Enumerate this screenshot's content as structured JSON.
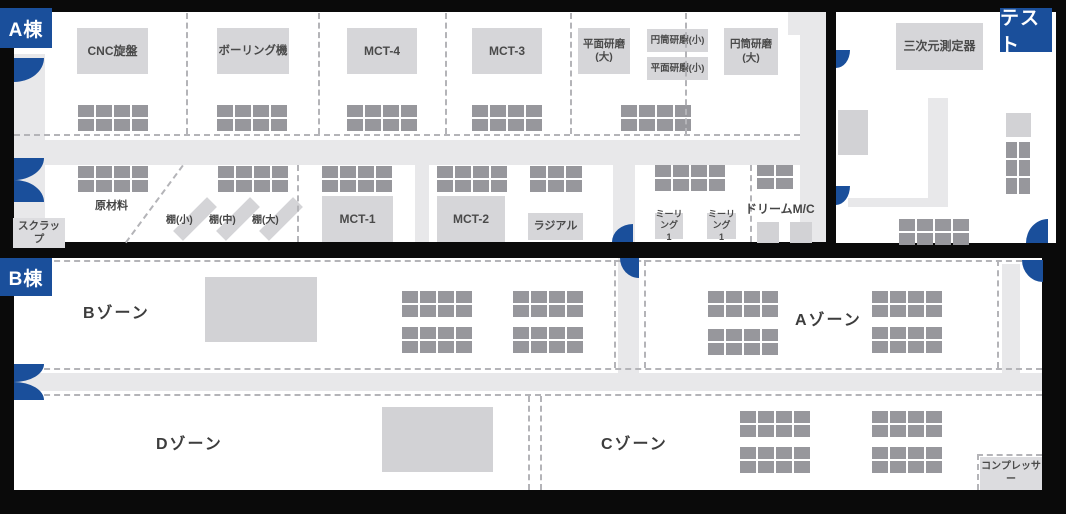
{
  "tags": {
    "building_a": "A棟",
    "building_b": "B棟",
    "test_room": "テスト"
  },
  "colors": {
    "background": "#0a0a0a",
    "interior": "#ffffff",
    "walkway": "#e8e8ea",
    "equipment_box": "#d6d6d9",
    "pallet": "#97979c",
    "accent_blue": "#1a4f9b",
    "dashed_line": "#b4b4b8",
    "label_text": "#454545"
  },
  "machines": [
    {
      "name": "machine-cnc-lathe",
      "label": "CNC旋盤",
      "x": 77,
      "y": 28,
      "w": 71,
      "h": 46,
      "fs": 12
    },
    {
      "name": "machine-boring",
      "label": "ボーリング機",
      "x": 217,
      "y": 28,
      "w": 72,
      "h": 46,
      "fs": 11.5
    },
    {
      "name": "machine-mct-4",
      "label": "MCT-4",
      "x": 347,
      "y": 28,
      "w": 70,
      "h": 46,
      "fs": 12
    },
    {
      "name": "machine-mct-3",
      "label": "MCT-3",
      "x": 472,
      "y": 28,
      "w": 70,
      "h": 46,
      "fs": 12
    },
    {
      "name": "machine-surface-grinder-large",
      "label": "平面研磨\n(大)",
      "x": 578,
      "y": 28,
      "w": 52,
      "h": 46,
      "fs": 10.5
    },
    {
      "name": "machine-cylindrical-grinder-small",
      "label": "円筒研磨(小)",
      "x": 647,
      "y": 29,
      "w": 61,
      "h": 23,
      "fs": 9.5
    },
    {
      "name": "machine-surface-grinder-small",
      "label": "平面研磨(小)",
      "x": 647,
      "y": 57,
      "w": 61,
      "h": 23,
      "fs": 9.5
    },
    {
      "name": "machine-cylindrical-grinder-large",
      "label": "円筒研磨\n(大)",
      "x": 724,
      "y": 28,
      "w": 54,
      "h": 47,
      "fs": 10.5
    },
    {
      "name": "machine-mct-1",
      "label": "MCT-1",
      "x": 322,
      "y": 196,
      "w": 71,
      "h": 46,
      "fs": 12
    },
    {
      "name": "machine-mct-2",
      "label": "MCT-2",
      "x": 437,
      "y": 196,
      "w": 68,
      "h": 46,
      "fs": 12
    },
    {
      "name": "machine-radial",
      "label": "ラジアル",
      "x": 528,
      "y": 213,
      "w": 55,
      "h": 27,
      "fs": 11
    },
    {
      "name": "machine-milling-1a",
      "label": "ミーリング\n1",
      "x": 655,
      "y": 213,
      "w": 28,
      "h": 26,
      "fs": 9
    },
    {
      "name": "machine-milling-1b",
      "label": "ミーリング\n1",
      "x": 707,
      "y": 213,
      "w": 29,
      "h": 26,
      "fs": 9
    },
    {
      "name": "machine-cmm",
      "label": "三次元測定器",
      "x": 896,
      "y": 23,
      "w": 87,
      "h": 47,
      "fs": 12
    },
    {
      "name": "area-scrap",
      "label": "スクラップ",
      "x": 13,
      "y": 218,
      "w": 52,
      "h": 30,
      "fs": 10.5,
      "light": true
    },
    {
      "name": "area-compressor",
      "label": "コンプレッサー",
      "x": 980,
      "y": 457,
      "w": 62,
      "h": 33,
      "fs": 10,
      "light": true
    }
  ],
  "plain_boxes": [
    {
      "name": "bzone-equipment-block",
      "x": 205,
      "y": 277,
      "w": 112,
      "h": 65
    },
    {
      "name": "dzone-equipment-block",
      "x": 382,
      "y": 407,
      "w": 111,
      "h": 65
    },
    {
      "name": "test-west-equipment-block",
      "x": 838,
      "y": 110,
      "w": 30,
      "h": 45
    },
    {
      "name": "test-east-equipment-block",
      "x": 1006,
      "y": 113,
      "w": 25,
      "h": 24
    },
    {
      "name": "dream-mc-unit-1",
      "x": 757,
      "y": 222,
      "w": 22,
      "h": 21
    },
    {
      "name": "dream-mc-unit-2",
      "x": 790,
      "y": 222,
      "w": 22,
      "h": 21
    }
  ],
  "labels": [
    {
      "name": "label-raw-materials",
      "text": "原材料",
      "x": 95,
      "y": 197,
      "fs": 11
    },
    {
      "name": "label-shelf-small",
      "text": "棚(小)",
      "x": 166,
      "y": 211,
      "fs": 10
    },
    {
      "name": "label-shelf-medium",
      "text": "棚(中)",
      "x": 209,
      "y": 211,
      "fs": 10
    },
    {
      "name": "label-shelf-large",
      "text": "棚(大)",
      "x": 252,
      "y": 211,
      "fs": 10
    },
    {
      "name": "label-dream-mc",
      "text": "ドリームM/C",
      "x": 745,
      "y": 200,
      "fs": 12
    }
  ],
  "zone_labels": [
    {
      "name": "label-zone-b",
      "text": "Bゾーン",
      "x": 83,
      "y": 299
    },
    {
      "name": "label-zone-a",
      "text": "Aゾーン",
      "x": 795,
      "y": 306
    },
    {
      "name": "label-zone-d",
      "text": "Dゾーン",
      "x": 156,
      "y": 430
    },
    {
      "name": "label-zone-c",
      "text": "Cゾーン",
      "x": 601,
      "y": 430
    }
  ],
  "shelves": [
    {
      "name": "shelf-small",
      "x": 188,
      "y": 195,
      "w": 14,
      "h": 48,
      "rot": 45
    },
    {
      "name": "shelf-medium",
      "x": 231,
      "y": 195,
      "w": 14,
      "h": 48,
      "rot": 45
    },
    {
      "name": "shelf-large",
      "x": 274,
      "y": 195,
      "w": 14,
      "h": 48,
      "rot": 45
    }
  ],
  "walkways": [
    {
      "name": "walkway-a-west",
      "x": 14,
      "y": 54,
      "w": 31,
      "h": 164
    },
    {
      "name": "walkway-a-main",
      "x": 14,
      "y": 140,
      "w": 812,
      "h": 25
    },
    {
      "name": "walkway-a-northeast",
      "x": 788,
      "y": 12,
      "w": 38,
      "h": 23
    },
    {
      "name": "walkway-a-east",
      "x": 800,
      "y": 12,
      "w": 26,
      "h": 230
    },
    {
      "name": "walkway-a-mid-1",
      "x": 415,
      "y": 165,
      "w": 14,
      "h": 77
    },
    {
      "name": "walkway-a-mid-2",
      "x": 613,
      "y": 165,
      "w": 22,
      "h": 77
    },
    {
      "name": "walkway-test-vertical",
      "x": 928,
      "y": 98,
      "w": 20,
      "h": 109
    },
    {
      "name": "walkway-test-horizontal",
      "x": 848,
      "y": 198,
      "w": 80,
      "h": 9
    },
    {
      "name": "walkway-b-main",
      "x": 14,
      "y": 373,
      "w": 1028,
      "h": 18
    },
    {
      "name": "walkway-b-mid",
      "x": 618,
      "y": 258,
      "w": 21,
      "h": 116
    },
    {
      "name": "walkway-b-east",
      "x": 1002,
      "y": 264,
      "w": 18,
      "h": 110
    }
  ],
  "dashed_lines": [
    {
      "name": "divider-a-1",
      "t": "v",
      "x": 186,
      "y": 13,
      "len": 121
    },
    {
      "name": "divider-a-2",
      "t": "v",
      "x": 318,
      "y": 13,
      "len": 121
    },
    {
      "name": "divider-a-3",
      "t": "v",
      "x": 445,
      "y": 13,
      "len": 121
    },
    {
      "name": "divider-a-4",
      "t": "v",
      "x": 570,
      "y": 13,
      "len": 121
    },
    {
      "name": "divider-a-5",
      "t": "v",
      "x": 685,
      "y": 13,
      "len": 121
    },
    {
      "name": "divider-a-top-row",
      "t": "h",
      "x": 14,
      "y": 134,
      "len": 786
    },
    {
      "name": "divider-shelf-east",
      "t": "v",
      "x": 297,
      "y": 165,
      "len": 77
    },
    {
      "name": "divider-dream-mc",
      "t": "v",
      "x": 750,
      "y": 165,
      "len": 77
    },
    {
      "name": "divider-scrap-diagonal",
      "t": "d",
      "x": 125,
      "y": 242,
      "len": 96,
      "rot": -53.5
    },
    {
      "name": "divider-b-north",
      "t": "h",
      "x": 14,
      "y": 260,
      "len": 1028
    },
    {
      "name": "divider-bzone-east",
      "t": "v",
      "x": 614,
      "y": 260,
      "len": 108
    },
    {
      "name": "divider-azone-west",
      "t": "v",
      "x": 644,
      "y": 260,
      "len": 108
    },
    {
      "name": "divider-azone-east",
      "t": "v",
      "x": 997,
      "y": 260,
      "len": 108
    },
    {
      "name": "divider-b-walkway-north",
      "t": "h",
      "x": 14,
      "y": 368,
      "len": 1028
    },
    {
      "name": "divider-b-walkway-south",
      "t": "h",
      "x": 14,
      "y": 394,
      "len": 1028
    },
    {
      "name": "divider-dc-1",
      "t": "v",
      "x": 528,
      "y": 396,
      "len": 94
    },
    {
      "name": "divider-dc-2",
      "t": "v",
      "x": 540,
      "y": 396,
      "len": 94
    },
    {
      "name": "divider-compressor-h",
      "t": "h",
      "x": 977,
      "y": 454,
      "len": 65
    },
    {
      "name": "divider-compressor-v",
      "t": "v",
      "x": 977,
      "y": 454,
      "len": 36
    }
  ],
  "pallet_grids": [
    {
      "name": "pallets-cnc",
      "x": 78,
      "y": 105,
      "cols": 4,
      "rows": 2
    },
    {
      "name": "pallets-boring",
      "x": 217,
      "y": 105,
      "cols": 4,
      "rows": 2
    },
    {
      "name": "pallets-mct4",
      "x": 347,
      "y": 105,
      "cols": 4,
      "rows": 2
    },
    {
      "name": "pallets-mct3",
      "x": 472,
      "y": 105,
      "cols": 4,
      "rows": 2
    },
    {
      "name": "pallets-grinders",
      "x": 621,
      "y": 105,
      "cols": 4,
      "rows": 2
    },
    {
      "name": "pallets-raw-materials",
      "x": 78,
      "y": 166,
      "cols": 4,
      "rows": 2
    },
    {
      "name": "pallets-shelf-area",
      "x": 218,
      "y": 166,
      "cols": 4,
      "rows": 2
    },
    {
      "name": "pallets-mct1",
      "x": 322,
      "y": 166,
      "cols": 4,
      "rows": 2
    },
    {
      "name": "pallets-mct2",
      "x": 437,
      "y": 166,
      "cols": 4,
      "rows": 2
    },
    {
      "name": "pallets-radial",
      "x": 530,
      "y": 166,
      "cols": 3,
      "rows": 2
    },
    {
      "name": "pallets-milling",
      "x": 655,
      "y": 165,
      "cols": 4,
      "rows": 2
    },
    {
      "name": "pallets-dream-mc",
      "x": 757,
      "y": 165,
      "cols": 2,
      "rows": 2,
      "cw": 17,
      "ch": 11
    },
    {
      "name": "pallets-test-east",
      "x": 1006,
      "y": 142,
      "cols": 2,
      "rows": 3,
      "cw": 11,
      "ch": 16
    },
    {
      "name": "pallets-test-south",
      "x": 899,
      "y": 219,
      "cols": 4,
      "rows": 2
    },
    {
      "name": "pallets-bzone-1",
      "x": 402,
      "y": 291,
      "cols": 4,
      "rows": 2
    },
    {
      "name": "pallets-bzone-2",
      "x": 402,
      "y": 327,
      "cols": 4,
      "rows": 2
    },
    {
      "name": "pallets-bzone-3",
      "x": 513,
      "y": 291,
      "cols": 4,
      "rows": 2
    },
    {
      "name": "pallets-bzone-4",
      "x": 513,
      "y": 327,
      "cols": 4,
      "rows": 2
    },
    {
      "name": "pallets-azone-1",
      "x": 708,
      "y": 291,
      "cols": 4,
      "rows": 2
    },
    {
      "name": "pallets-azone-2",
      "x": 708,
      "y": 329,
      "cols": 4,
      "rows": 2
    },
    {
      "name": "pallets-azone-3",
      "x": 872,
      "y": 291,
      "cols": 4,
      "rows": 2
    },
    {
      "name": "pallets-azone-4",
      "x": 872,
      "y": 327,
      "cols": 4,
      "rows": 2
    },
    {
      "name": "pallets-czone-1",
      "x": 740,
      "y": 411,
      "cols": 4,
      "rows": 2
    },
    {
      "name": "pallets-czone-2",
      "x": 740,
      "y": 447,
      "cols": 4,
      "rows": 2
    },
    {
      "name": "pallets-czone-3",
      "x": 872,
      "y": 411,
      "cols": 4,
      "rows": 2
    },
    {
      "name": "pallets-czone-4",
      "x": 872,
      "y": 447,
      "cols": 4,
      "rows": 2
    }
  ],
  "doors": [
    {
      "name": "door-a-west-upper",
      "x": 14,
      "y": 58,
      "w": 30,
      "h": 24,
      "c": "br"
    },
    {
      "name": "door-a-west-double-top",
      "x": 14,
      "y": 158,
      "w": 30,
      "h": 22,
      "c": "br"
    },
    {
      "name": "door-a-west-double-bottom",
      "x": 14,
      "y": 180,
      "w": 30,
      "h": 22,
      "c": "tr"
    },
    {
      "name": "door-a-south",
      "x": 612,
      "y": 224,
      "w": 21,
      "h": 18,
      "c": "tl"
    },
    {
      "name": "door-test-west-upper",
      "x": 836,
      "y": 50,
      "w": 14,
      "h": 18,
      "c": "br"
    },
    {
      "name": "door-test-west-lower",
      "x": 836,
      "y": 186,
      "w": 14,
      "h": 19,
      "c": "br"
    },
    {
      "name": "door-test-southeast",
      "x": 1026,
      "y": 219,
      "w": 22,
      "h": 24,
      "c": "tl"
    },
    {
      "name": "door-b-north-mid",
      "x": 620,
      "y": 258,
      "w": 19,
      "h": 20,
      "c": "bl"
    },
    {
      "name": "door-b-northeast",
      "x": 1022,
      "y": 260,
      "w": 21,
      "h": 22,
      "c": "bl"
    },
    {
      "name": "door-b-west-double-top",
      "x": 14,
      "y": 364,
      "w": 30,
      "h": 18,
      "c": "br"
    },
    {
      "name": "door-b-west-double-bottom",
      "x": 14,
      "y": 382,
      "w": 30,
      "h": 18,
      "c": "tr"
    }
  ]
}
